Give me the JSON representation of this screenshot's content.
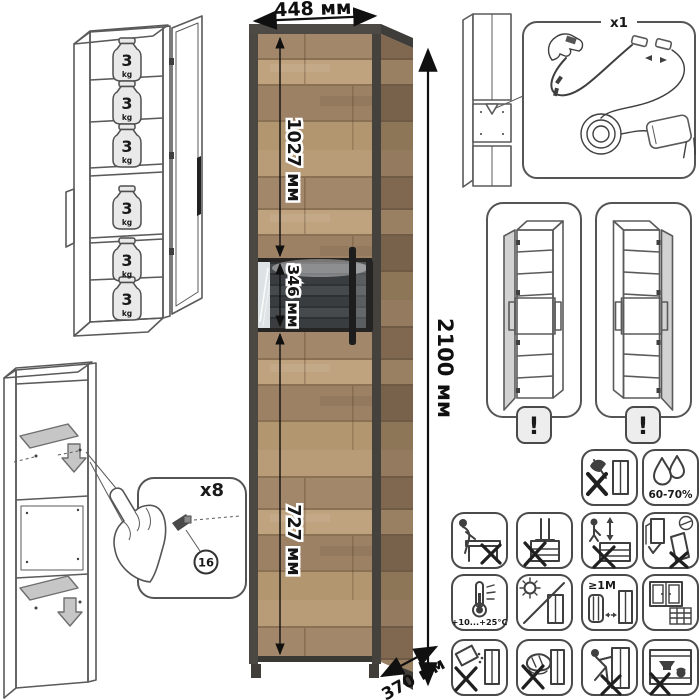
{
  "product": {
    "dimensions": {
      "width": "448 мм",
      "height": "2100 мм",
      "upper_door": "1027 мм",
      "display_section": "346 мм",
      "lower_door": "727 мм",
      "depth": "370 мм"
    },
    "shelf_load": {
      "value": "3",
      "unit": "kg",
      "shelf_count": 6
    }
  },
  "led_kit": {
    "quantity": "x1"
  },
  "variants": {
    "warning": "!"
  },
  "assembly": {
    "fasteners": "x8",
    "part_number": "16"
  },
  "care": {
    "humidity": "60-70%",
    "temperature": "+10...+25°C",
    "heat_distance": "≥1M",
    "icons": [
      "no-impact",
      "humidity-60-70",
      "no-sitting",
      "no-standing-on-top",
      "no-climbing",
      "anchor-to-wall",
      "temperature-range",
      "no-direct-sunlight",
      "keep-1m-from-heat",
      "ventilate-room",
      "no-liquids",
      "no-abrasive-cleaning",
      "no-dragging",
      "no-heavy-items-inside"
    ]
  }
}
